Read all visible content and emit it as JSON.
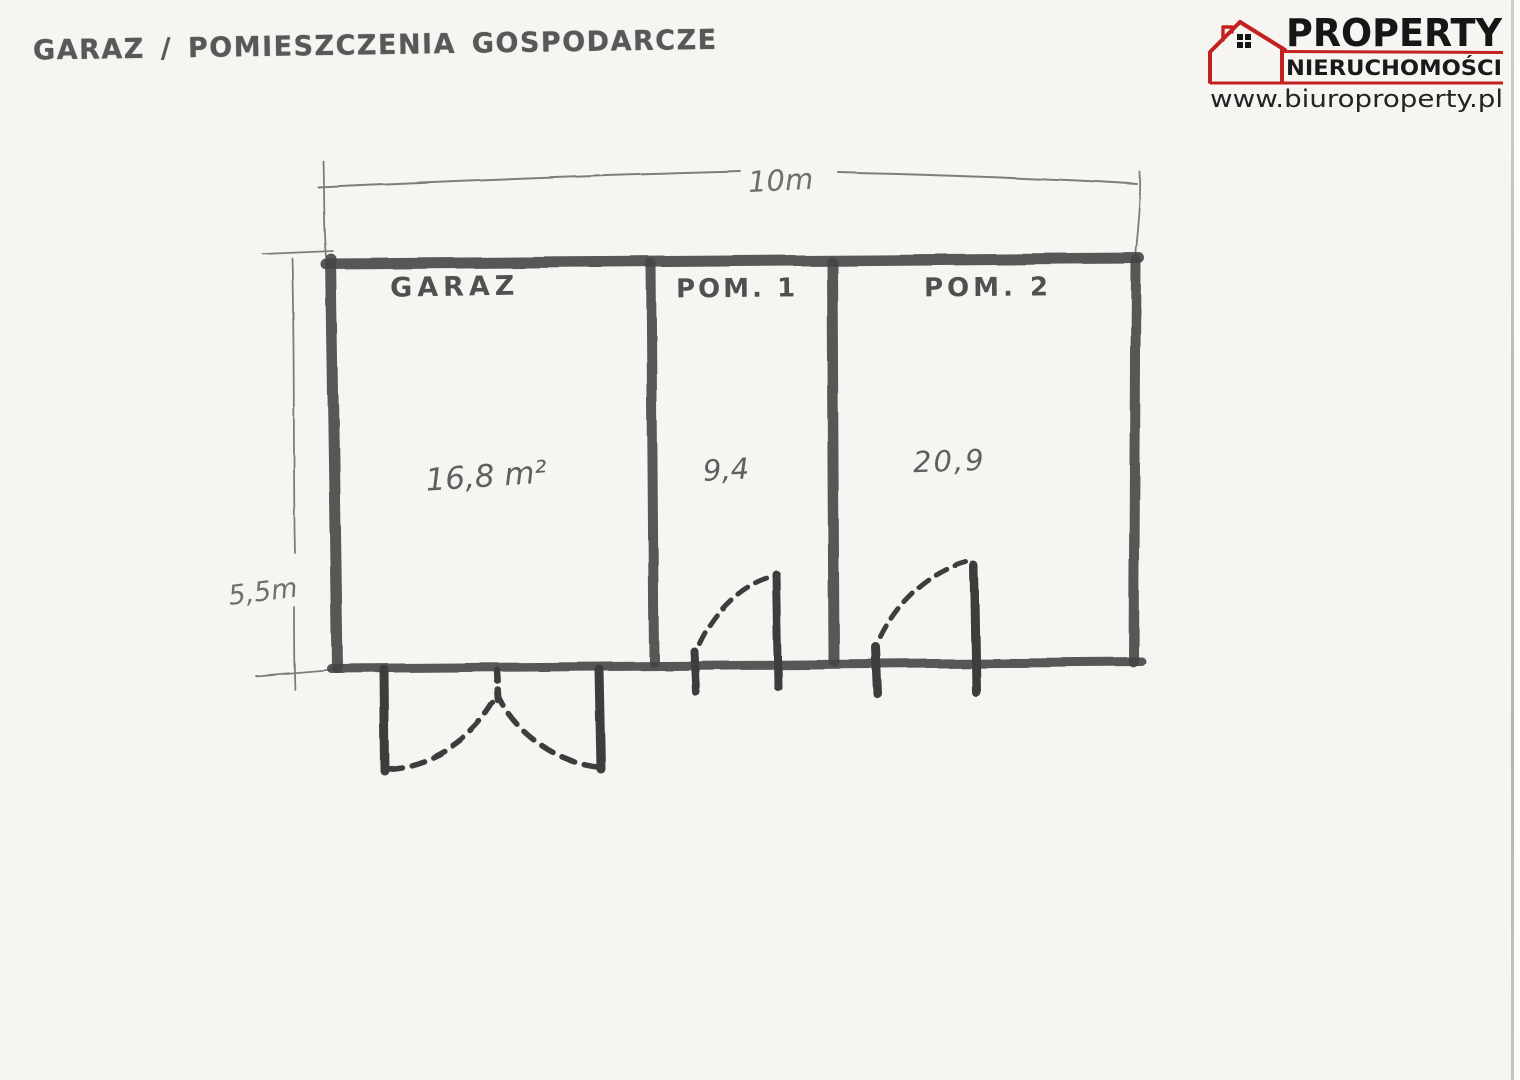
{
  "title": "GARAZ / POMIESZCZENIA GOSPODARCZE",
  "logo": {
    "brand": "PROPERTY",
    "subtitle": "NIERUCHOMOŚCI",
    "website": "www.biuroproperty.pl",
    "accent_color": "#c3211f"
  },
  "plan": {
    "rooms": [
      {
        "name": "GARAZ",
        "area": "16,8 m²"
      },
      {
        "name": "POM. 1",
        "area": "9,4"
      },
      {
        "name": "POM. 2",
        "area": "20,9"
      }
    ],
    "dimensions": {
      "total_width": "10m",
      "total_height": "5,5m"
    }
  },
  "colors": {
    "marker_ink": "#454545",
    "pen_ink": "#5f5f5f",
    "pencil": "#7d7d7d",
    "paper": "#f6f5f2"
  }
}
